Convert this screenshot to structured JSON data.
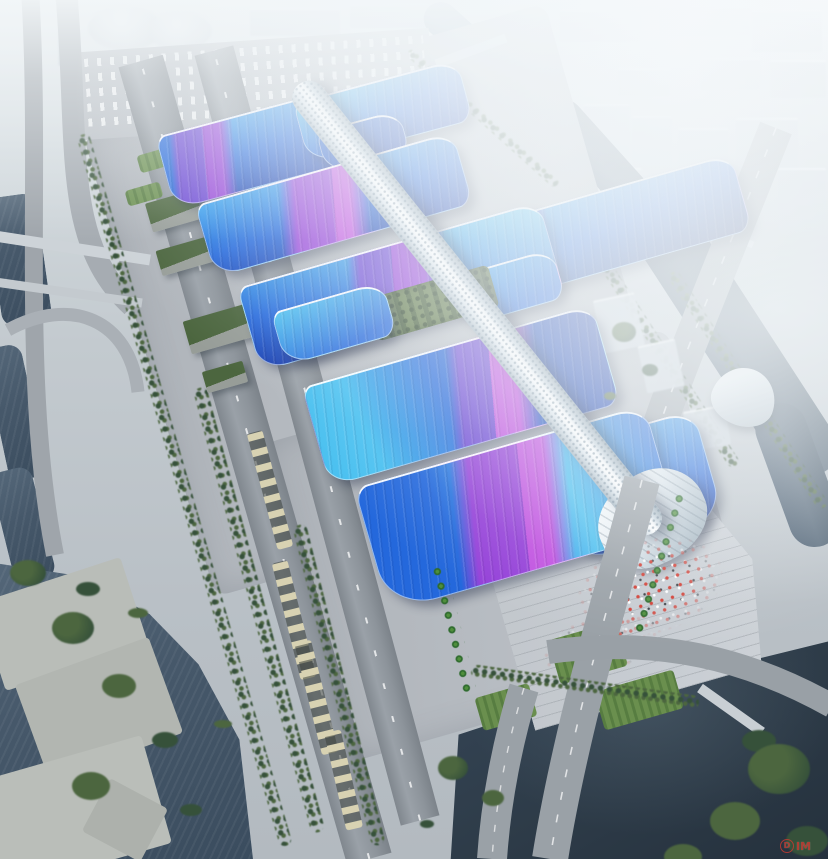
{
  "meta": {
    "type": "architectural-aerial-rendering",
    "subject": "Bird's-eye rendering of a large exhibition and convention center: rows of wavy blue roofs with purple ribbon bands flank a white lattice valley spine ending in a silver shell entrance, surrounded by grey aprons, tree-lined boulevards, canals, rivers and a hazy white city skyline"
  },
  "watermark": {
    "badge": "D",
    "text": "IM"
  },
  "palette": {
    "city": "#cdd5dc",
    "water_canal": "#7d95a8",
    "water_river": "#4d6072",
    "water_lake": "#46586a",
    "water_dark": "#2e3c49",
    "road": "#9aa1a8",
    "apron": "#b6bbc1",
    "plaza": "#c7ccd2",
    "tree": "#4c663f",
    "tree_dark": "#36513a",
    "lawn": "#6a8f4e",
    "bus": "#d8d2b2",
    "garden": "#55703c",
    "roof_light": "#35a0ee",
    "roof_mid": "#2468dc",
    "roof_deep": "#1b3fae",
    "roof_navy": "#162a6e",
    "cyan": "#49c0f0",
    "violet": "#6b46d4",
    "purple": "#9440d8",
    "magenta": "#c050e0",
    "spine": "#e6edf2",
    "shell": "#dfe8ee",
    "people_red": "#d23f35",
    "watermark_red": "#c23b32"
  }
}
